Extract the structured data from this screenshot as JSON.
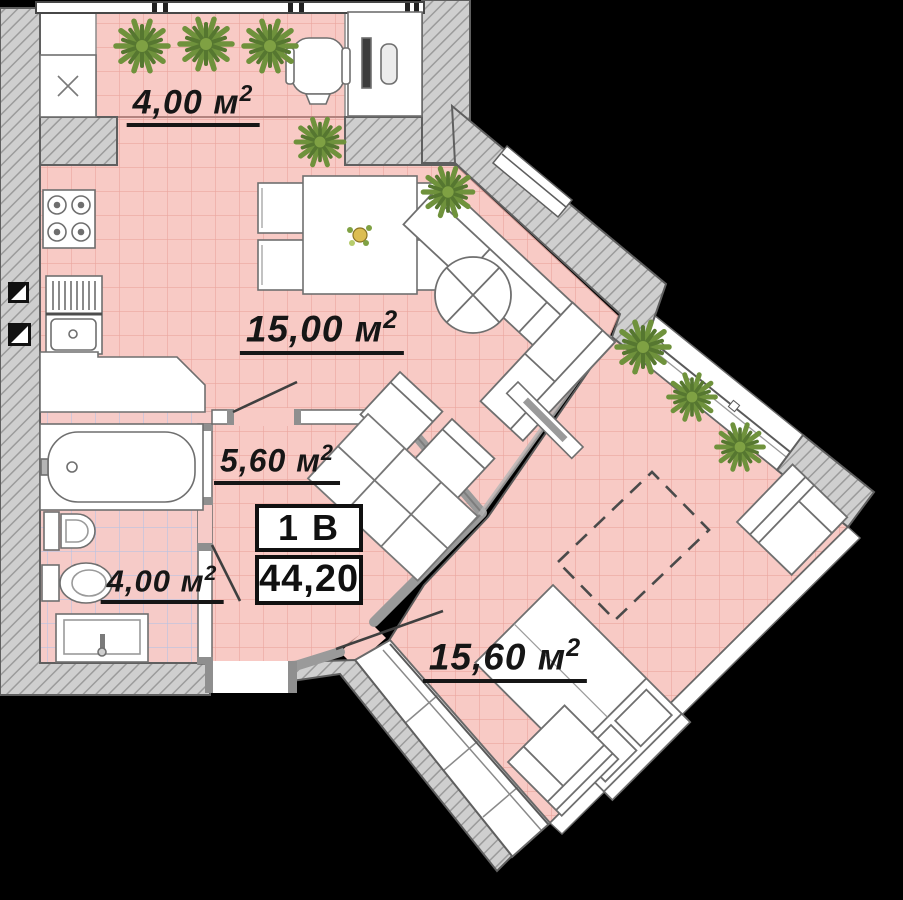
{
  "plan": {
    "title": "apartment-floor-plan",
    "unit_card": {
      "unit_label": "1 В",
      "total_area": "44,20"
    },
    "labels": {
      "unit": "м",
      "sup": "2",
      "decimal_style": "comma"
    },
    "rooms": {
      "loggia": {
        "name": "loggia-balcony",
        "value": "4,00"
      },
      "kitchen_living": {
        "name": "kitchen-living",
        "value": "15,00"
      },
      "hallway": {
        "name": "hallway",
        "value": "5,60"
      },
      "bathroom": {
        "name": "bathroom",
        "value": "4,00"
      },
      "bedroom": {
        "name": "bedroom",
        "value": "15,60"
      }
    },
    "colors": {
      "floor_pink": "#f8cac5",
      "floor_grid": "#e59790",
      "bath_grid": "#9fb0dc",
      "wall_fill": "#cfcfcf",
      "wall_hatch": "#9e9e9e",
      "outline": "#5a5a5a",
      "plant_green": "#74923d",
      "text": "#161616"
    }
  }
}
